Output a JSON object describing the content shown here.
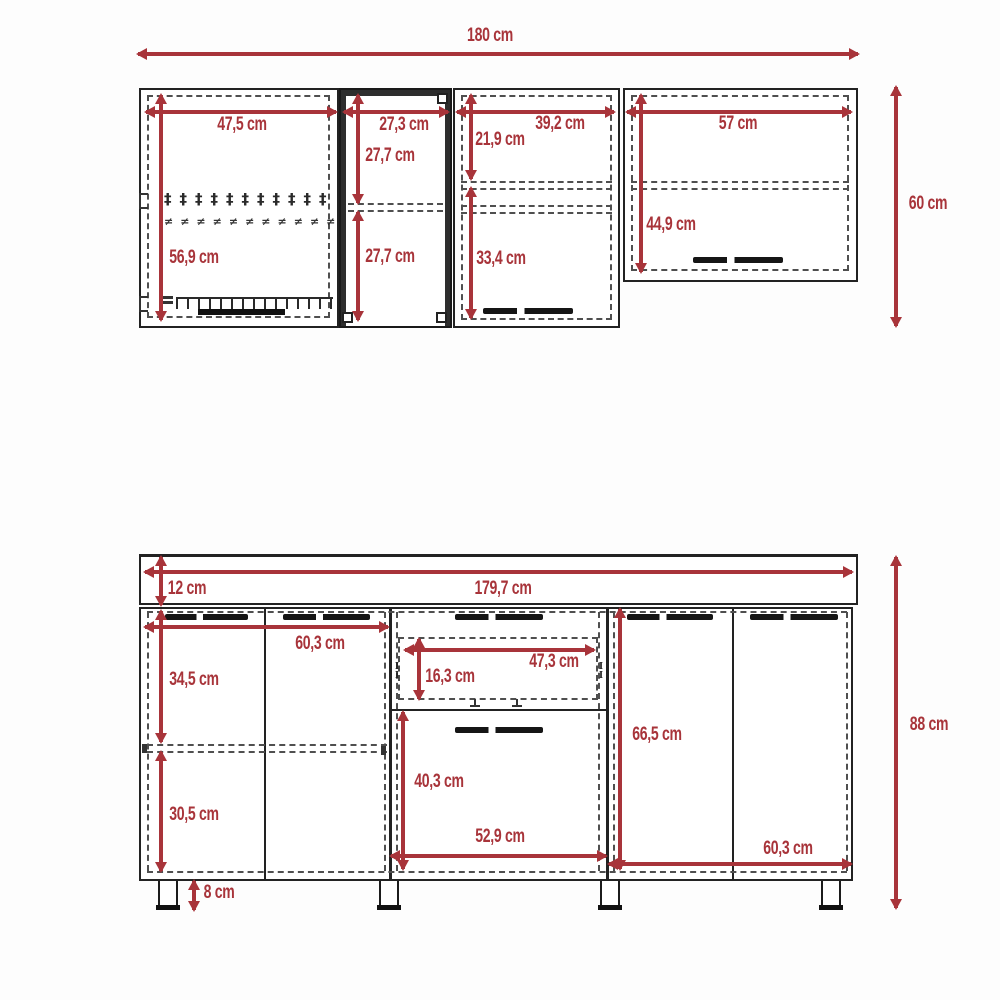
{
  "colors": {
    "dimension_red": "#a8343a",
    "outline": "#222222",
    "dashed_line": "#4f4f4f"
  },
  "upper_cabinet": {
    "total_width": "180 cm",
    "total_height": "60 cm",
    "left_door": {
      "width": "47,5 cm",
      "height": "56,9 cm"
    },
    "open_unit": {
      "width": "27,3 cm",
      "top_section": "27,7 cm",
      "bottom_section": "27,7 cm"
    },
    "middle_door": {
      "width": "39,2 cm",
      "top_section": "21,9 cm",
      "bottom_section": "33,4 cm"
    },
    "right_door": {
      "width": "57 cm",
      "height": "44,9 cm"
    }
  },
  "base_cabinet": {
    "total_width": "179,7 cm",
    "total_height": "88 cm",
    "countertop_height": "12 cm",
    "left_doors": {
      "width": "60,3 cm",
      "top_section": "34,5 cm",
      "bottom_section": "30,5 cm"
    },
    "drawer": {
      "width": "47,3 cm",
      "height": "16,3 cm"
    },
    "center_door": {
      "width": "52,9 cm",
      "height": "40,3 cm"
    },
    "right_doors": {
      "width": "60,3 cm",
      "height": "66,5 cm"
    },
    "leg_height": "8 cm"
  },
  "icons": {
    "plate_rack_row1": "‡‡‡‡‡‡‡‡‡‡‡",
    "plate_rack_row2": "≠≠≠≠≠≠≠≠≠≠≠",
    "drawer_runner": "I\nI"
  }
}
